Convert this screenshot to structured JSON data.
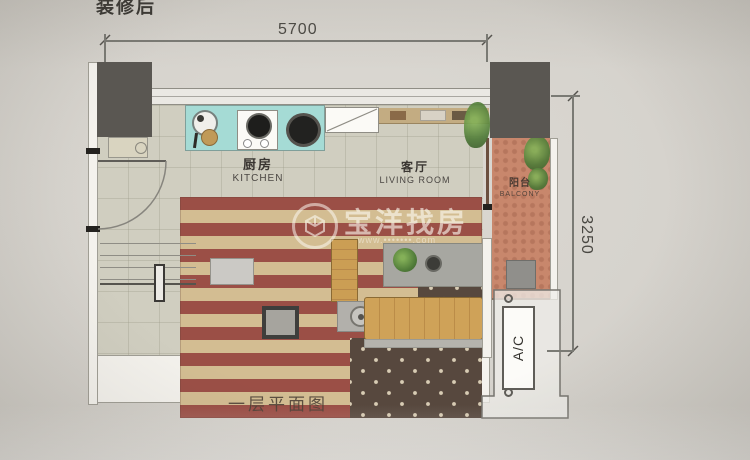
{
  "title": "装修后",
  "plan": {
    "caption": "一层平面图",
    "dimensions": {
      "width_mm": "5700",
      "height_mm": "3250"
    },
    "rooms": [
      {
        "id": "kitchen",
        "zh": "厨房",
        "en": "KITCHEN"
      },
      {
        "id": "living-room",
        "zh": "客厅",
        "en": "LIVING ROOM"
      },
      {
        "id": "balcony",
        "zh": "阳台",
        "en": "BALCONY"
      }
    ],
    "equipment": {
      "ac_label": "A/C"
    }
  },
  "watermark": {
    "brand": "宝洋找房",
    "url": "www.•••••••.com"
  },
  "colors": {
    "paper": "#d6d3cd",
    "pillar_gray": "#5a5752",
    "counter_teal": "#a5dbd5",
    "balcony_salmon": "#c8876c",
    "flag_red": "#9b4f46",
    "flag_cream": "#d3bd92",
    "flag_star_field": "#57483e",
    "wood": "#c89a52"
  }
}
